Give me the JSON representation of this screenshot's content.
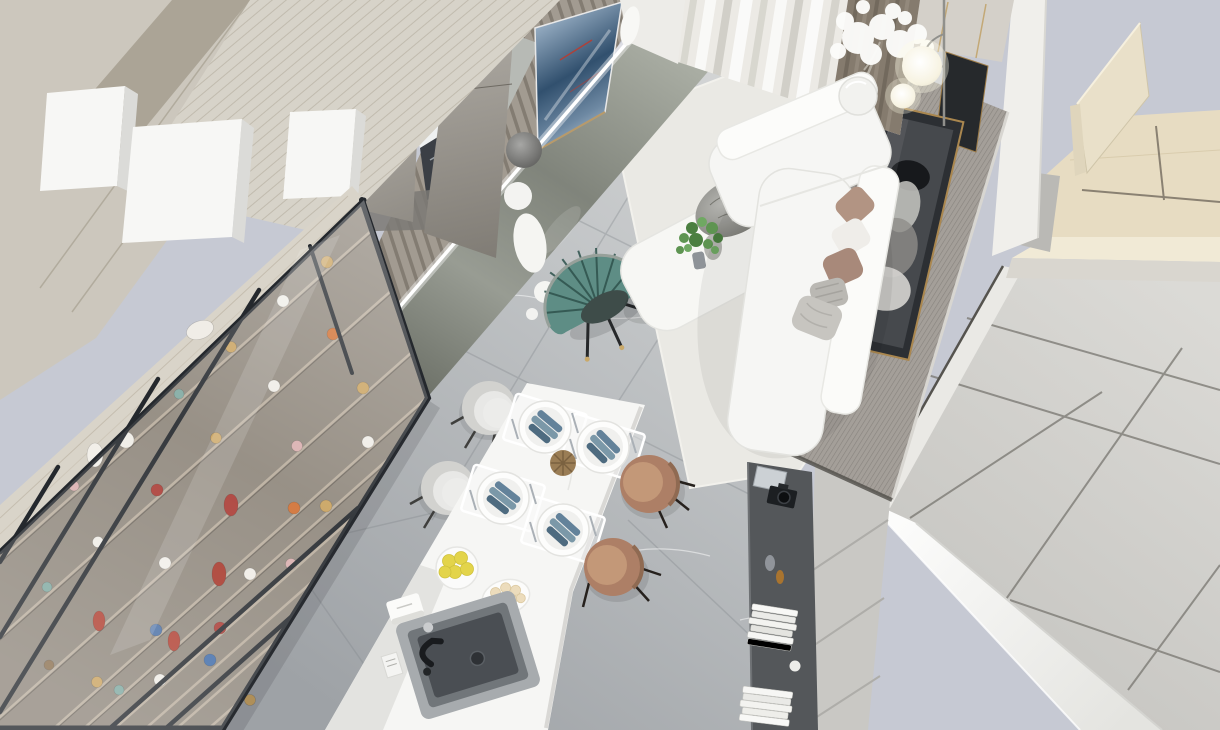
{
  "scene": {
    "description": "Top-down 3D architectural render of a modern open-plan apartment: white living room with L-shaped sofa and TV wall, white dining table with four place settings, kitchen island with grey sink, glass display cabinet full of collectible figurines, grey marble floor, light wood panelling and a sectioned ceiling plane on the right, all on a pale lavender-grey backdrop",
    "view": "aerial axonometric dollhouse view",
    "style": "modern minimalist interior render",
    "areas": [
      {
        "name": "living-area",
        "objects": [
          "white L-shaped sectional sofa",
          "taupe and grey cushions",
          "grey throw blanket",
          "white coffee table",
          "grey rock sculpture",
          "green potted plant",
          "white area rug",
          "teal pleated fan accent chair",
          "white cylinder side table",
          "floor lamp with two glowing globes",
          "white decorative blossom tree in vase",
          "sheer curtains with taupe drapes",
          "slatted TV wall with felt panel",
          "wall TV showing blue scene",
          "stone media plinth",
          "LED light strips",
          "white bear figurine",
          "framed monochrome portrait",
          "grey mesh feature wall with brass trim"
        ]
      },
      {
        "name": "dining-area",
        "objects": [
          "white marble dining table",
          "four white plates with blue folded napkins",
          "clear placemats with cutlery",
          "rattan ball centerpiece",
          "bowl of lemons",
          "plate of pastries",
          "two grey upholstered chairs",
          "two tan leather chairs"
        ]
      },
      {
        "name": "kitchen-island",
        "objects": [
          "white waterfall island",
          "grey composite sink",
          "black faucet",
          "tissue box",
          "recipe card"
        ]
      },
      {
        "name": "display-wall",
        "objects": [
          "black-framed glass display cabinet",
          "collectible figurines in gold, white, red, orange, teal and blue",
          "light wood shelving"
        ]
      },
      {
        "name": "media-console",
        "objects": [
          "charcoal console shelf",
          "camera",
          "stacked white books",
          "small figurines"
        ]
      },
      {
        "name": "structure",
        "objects": [
          "grey laminate columns",
          "greige angled wall panels",
          "white pillars",
          "kitchen niche with dark drawers",
          "light grey ceiling panels with dark reveals",
          "white structural beam",
          "beige wood ceiling section with upright fins",
          "partition wall with seams"
        ]
      }
    ],
    "palette": {
      "bg": "#c6c9d3",
      "floor-light": "#d6d8d8",
      "floor-dark": "#a3a7ab",
      "rug": "#eae9e4",
      "white-furniture": "#f6f6f4",
      "wood-light": "#d9d4c9",
      "greige": "#ccc7bd",
      "column": "#b3afa8",
      "frame-dark": "#24282d",
      "shelf-interior": "#8f877c",
      "teal": "#5e8d85",
      "tan": "#ad7f66",
      "stone": "#84887f",
      "mesh": "#a49f99",
      "ceiling": "#d4d3cf",
      "beige-wood": "#e7dcc2",
      "gold": "#bf9f62",
      "tv-blue": "#48688c",
      "plant-green": "#5e9451",
      "console": "#54575a",
      "led": "#ffffff"
    }
  }
}
